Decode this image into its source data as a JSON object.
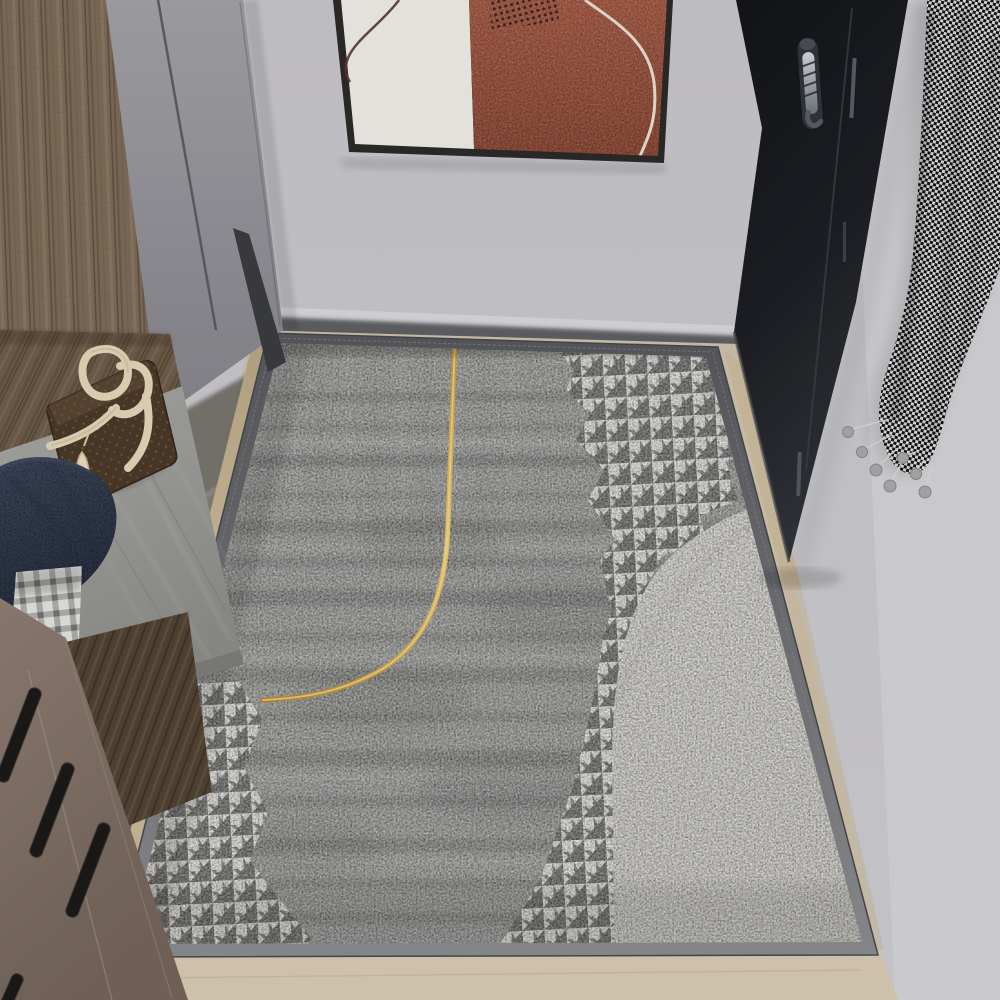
{
  "scene": {
    "image_type": "photograph",
    "setting": "entryway-hallway-with-area-rug",
    "objects": [
      "abstract-wall-art",
      "entry-door",
      "door-handle",
      "houndstooth-scarf",
      "wardrobe-cabinet",
      "wood-side-panel",
      "storage-bench",
      "plastic-wrapped-cushion",
      "leather-handbag",
      "navy-throw-pillow",
      "gingham-cloth",
      "drawer-chest",
      "drawer-handles",
      "area-rug",
      "rug-gold-accent-line",
      "rug-ivory-arch",
      "rug-houndstooth-patches",
      "tile-floor"
    ]
  },
  "colors": {
    "wall": "#c7c6ca",
    "wall_light": "#d6d5d9",
    "skirting_shadow": "#5d5f64",
    "art_frame": "#2b2a28",
    "art_panel_white": "#efece7",
    "art_panel_rust": "#ad5a42",
    "art_rust_deep": "#8e4430",
    "art_line_maroon": "#5c3334",
    "art_line_cream": "#e9dfcd",
    "door": "#131418",
    "door_soft": "#31343a",
    "handle_steel": "#d3d8dd",
    "scarf_dark": "#131313",
    "scarf_light": "#ececec",
    "pompom": "#a9a9a9",
    "wood": "#7e6b58",
    "wood_dark": "#5f4e3d",
    "cabinet_gray": "#a2a1a6",
    "cabinet_seam": "#55555a",
    "cushion": "#a8a8a5",
    "pillow_navy": "#414c63",
    "plaid_light": "#e2e2e0",
    "plaid_dark": "#9b9b99",
    "bag_body": "#4a3727",
    "bag_strap": "#e3d5b9",
    "drawer": "#8d7c72",
    "drawer_handle": "#1b1918",
    "floor": "#d8cbb4",
    "floor_shadow": "#6f6a64",
    "rug_border": "#55575b",
    "rug_binding": "#d6c6a4",
    "rug_base": "#a0a09e",
    "rug_streak": "#585955",
    "rug_light": "#d3d3cf",
    "hound_dark": "#6f6f6d",
    "hound_light": "#e8e6e1",
    "ivory": "#e1dfd7",
    "gold": "#c59a38",
    "gold_light": "#eacb6e"
  }
}
